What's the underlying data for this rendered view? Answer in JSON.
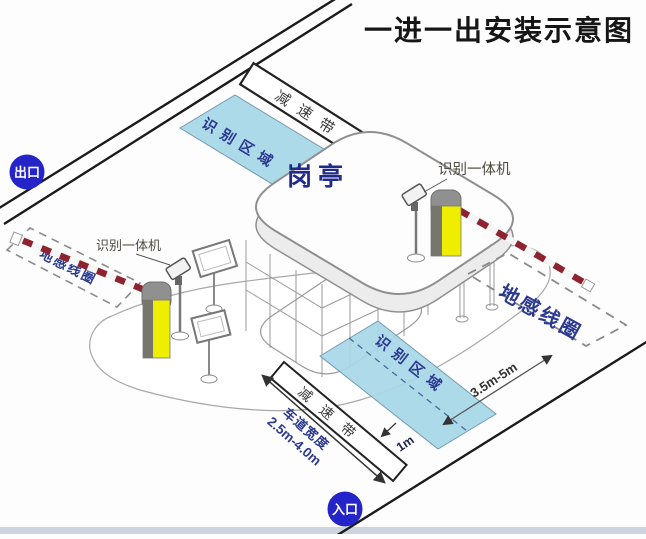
{
  "title": "一进一出安装示意图",
  "markers": {
    "exit": "出口",
    "entrance": "入口"
  },
  "booth": {
    "label": "岗亭"
  },
  "zones": {
    "top_recognition": "识别区域",
    "bottom_recognition": "识别区域"
  },
  "speed_bumps": {
    "top": "减速带",
    "bottom": "减速带"
  },
  "ground_loops": {
    "left": "地感线圈",
    "right": "地感线圈"
  },
  "camera_labels": {
    "left": "识别一体机",
    "right": "识别一体机"
  },
  "dimensions": {
    "loop_to_zone": "3.5m-5m",
    "stop_line": "1m",
    "lane_width_label": "车道宽度",
    "lane_width_value": "2.5m-4.0m"
  },
  "colors": {
    "marker_blue": "#2424c8",
    "zone_blue": "#a8d8e8",
    "barrier_yellow": "#f0ee00",
    "barrier_red": "#8e2330",
    "label_navy": "#2b3990",
    "line_black": "#1a1a1a"
  }
}
